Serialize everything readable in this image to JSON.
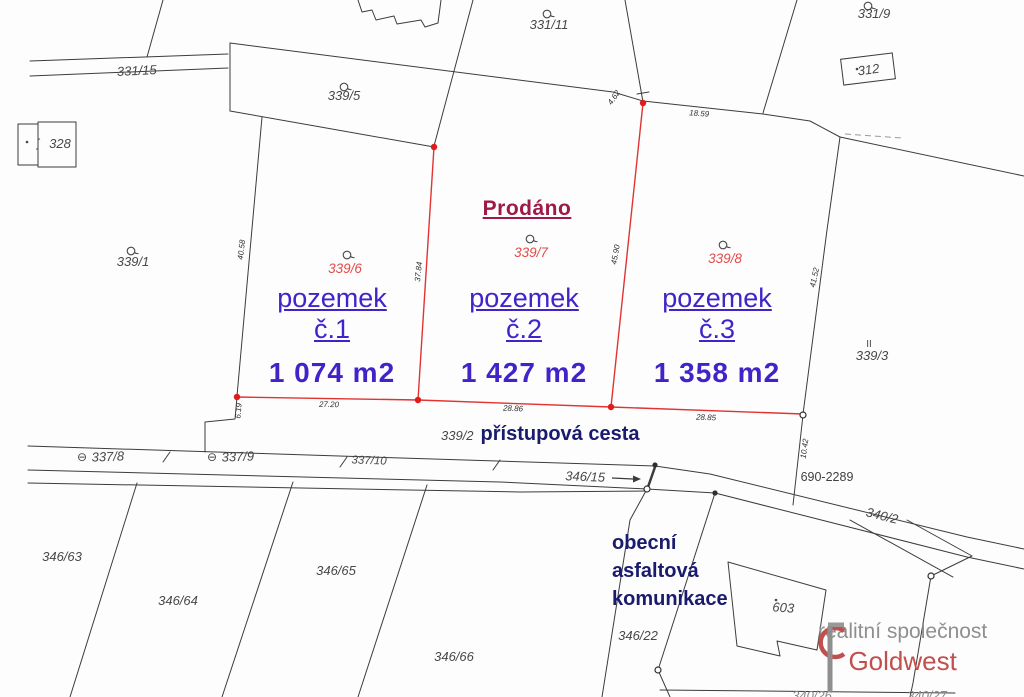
{
  "highlight": {
    "sold": "Prodáno",
    "plots": [
      {
        "parcel": "339/6",
        "title": "pozemek",
        "subtitle": "č.1",
        "area": "1 074 m2"
      },
      {
        "parcel": "339/7",
        "title": "pozemek",
        "subtitle": "č.2",
        "area": "1 427 m2"
      },
      {
        "parcel": "339/8",
        "title": "pozemek",
        "subtitle": "č.3",
        "area": "1 358 m2"
      }
    ],
    "access_road": {
      "parcel": "339/2",
      "name": "přístupová cesta"
    },
    "road_note": {
      "line1": "obecní",
      "line2": "asfaltová",
      "line3": "komunikace"
    }
  },
  "parcels": {
    "p331_15": "331/15",
    "p339_5": "339/5",
    "p331_11": "331/11",
    "p331_9": "331/9",
    "b312": "312",
    "b328": "328",
    "p339_1": "339/1",
    "p339_3": "339/3",
    "p337_8": "337/8",
    "p337_9": "337/9",
    "p337_10": "337/10",
    "p346_15": "346/15",
    "p690_2289": "690-2289",
    "p340_2": "340/2",
    "p346_63": "346/63",
    "p346_64": "346/64",
    "p346_65": "346/65",
    "p346_66": "346/66",
    "p346_22": "346/22",
    "b603": "603",
    "p340_26": "340/26",
    "p340_27": "340/27"
  },
  "dimensions": {
    "d4_62": "4.62",
    "d18_59": "18.59",
    "d40_58": "40.58",
    "d37_84": "37.84",
    "d45_90": "45.90",
    "d41_52": "41.52",
    "d27_20": "27.20",
    "d28_86": "28.86",
    "d28_85": "28.85",
    "d6_19": "6.19",
    "d10_42": "10.42"
  },
  "symbols": {
    "theta": "⊖",
    "double_bar": "II",
    "s_mark": "ʃ"
  },
  "watermark": {
    "tagline": "realitní společnost",
    "brand": "Goldwest"
  },
  "colors": {
    "boundary_line": "#3c3c3c",
    "highlight_line": "#e23333",
    "highlight_point": "#e01b1b",
    "plot_text": "#4123c9",
    "sold_text": "#9e1848",
    "road_text": "#1a1a6e",
    "parcel_text": "#474747",
    "red_parcel_text": "#e14b4b",
    "brand_red": "#c0504d",
    "brand_gray": "#8f8f8f"
  }
}
